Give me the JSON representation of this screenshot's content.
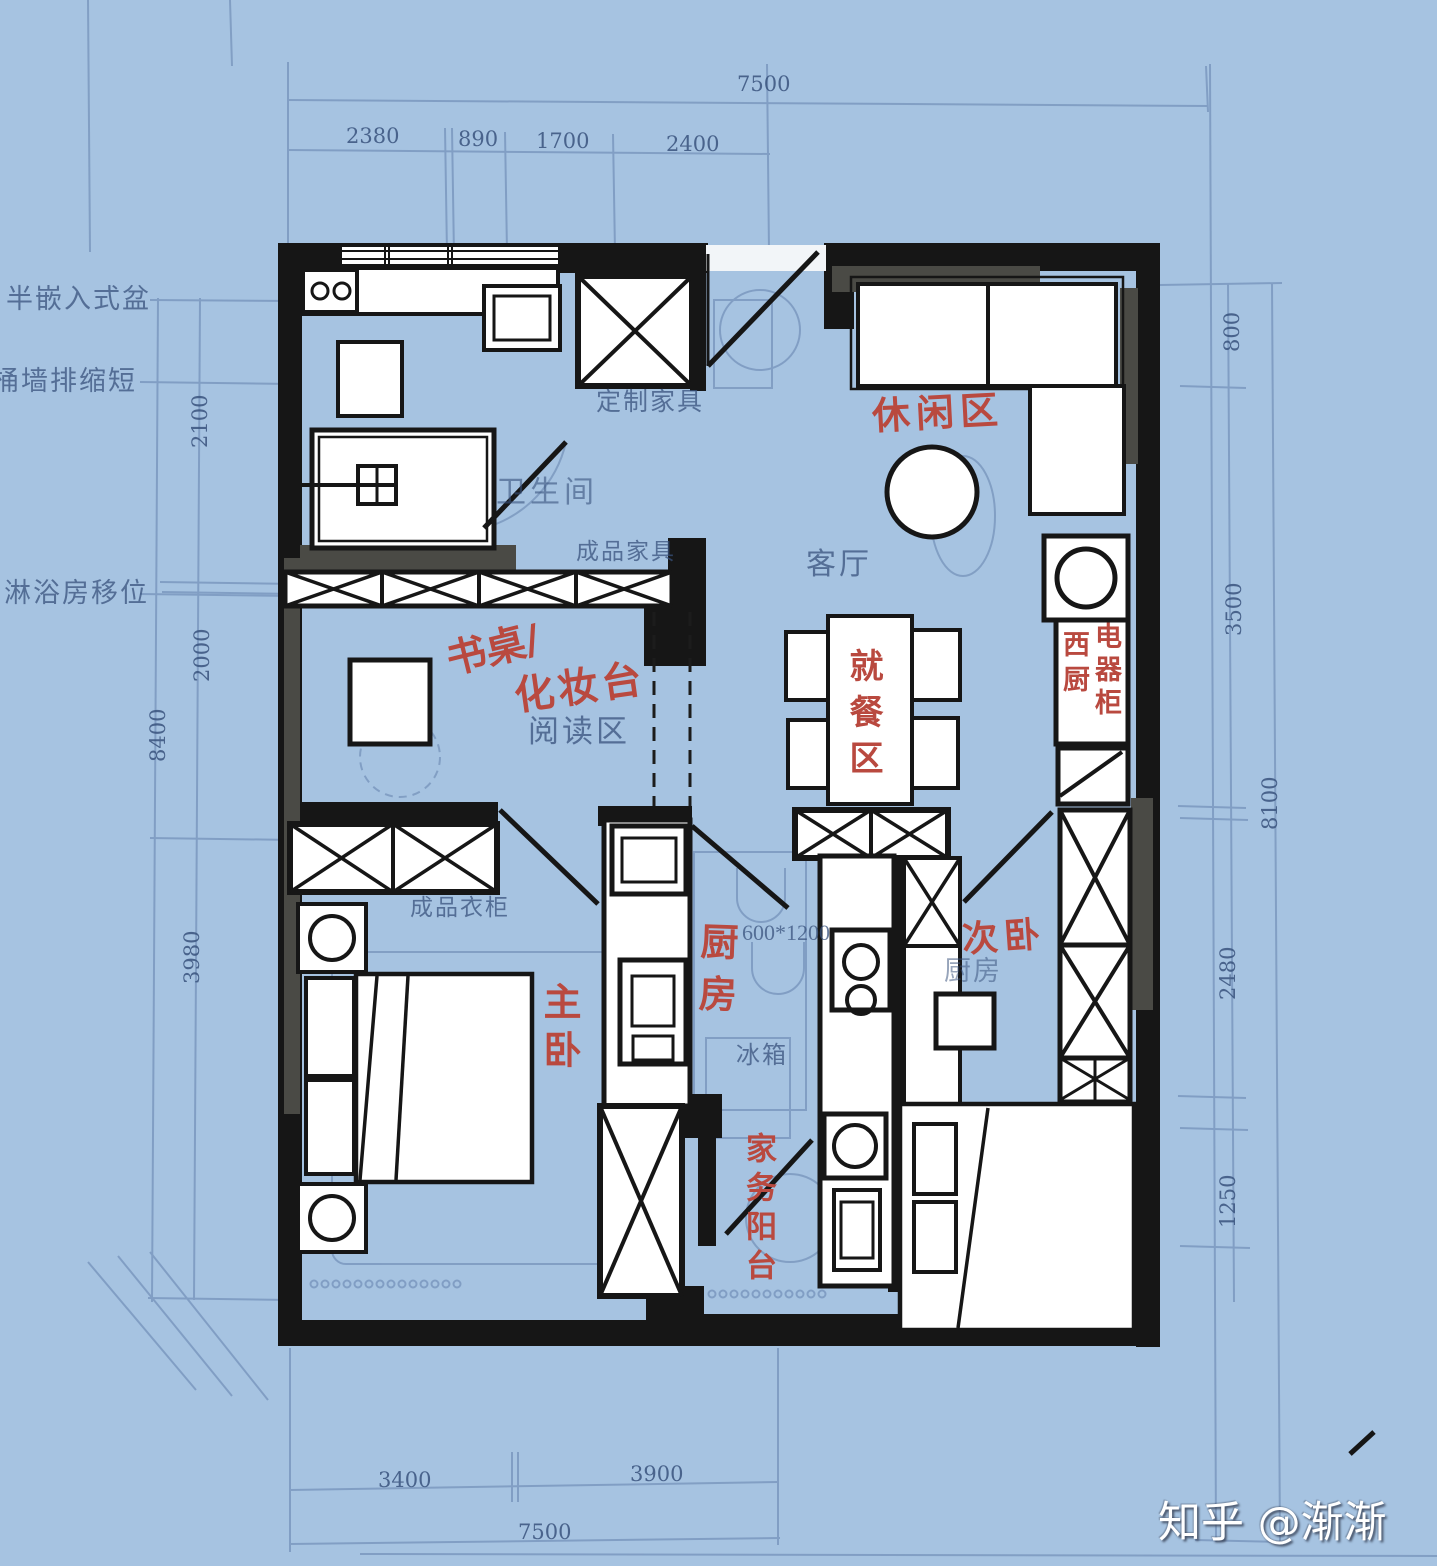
{
  "watermark": {
    "text": "知乎 @渐渐"
  },
  "annotations": {
    "leisure_area": "休闲区",
    "desk": "书桌/",
    "vanity": "化妆台",
    "dining_area": "就餐区",
    "west_kitchen": "西厨",
    "appliance_cabinet": "电器柜",
    "kitchen": "厨房",
    "master_bedroom": "主卧",
    "second_bedroom": "次卧",
    "laundry_balcony": "家务阳台"
  },
  "blueprint_labels": {
    "semi_recessed_basin": "半嵌入式盆",
    "toilet_wall_drain_shortened": "桶墙排缩短",
    "shower_room_relocated": "淋浴房移位",
    "bathroom": "卫生间",
    "custom_furniture": "定制家具",
    "finished_furniture": "成品家具",
    "reading_area": "阅读区",
    "living_room": "客厅",
    "finished_wardrobe": "成品衣柜",
    "counter_size": "600*1200",
    "fridge": "冰箱",
    "kitchen_bp": "厨房"
  },
  "dimensions": {
    "top_total": "7500",
    "top_segments": [
      "2380",
      "890",
      "1700",
      "2400"
    ],
    "left_segments": [
      "2100",
      "2000",
      "3980"
    ],
    "left_total": "8400",
    "right_segments": [
      "800",
      "3500",
      "2480",
      "1250"
    ],
    "right_total": "8100",
    "bottom_segments": [
      "3400",
      "3900"
    ],
    "bottom_total": "7500"
  },
  "colors": {
    "background": "#a6c3e1",
    "blueprint_line": "#5d7ba8",
    "ink": "#161616",
    "wall_shade": "#4a4a45",
    "annotation_red": "#b9493f",
    "furniture_fill": "#ffffff"
  }
}
